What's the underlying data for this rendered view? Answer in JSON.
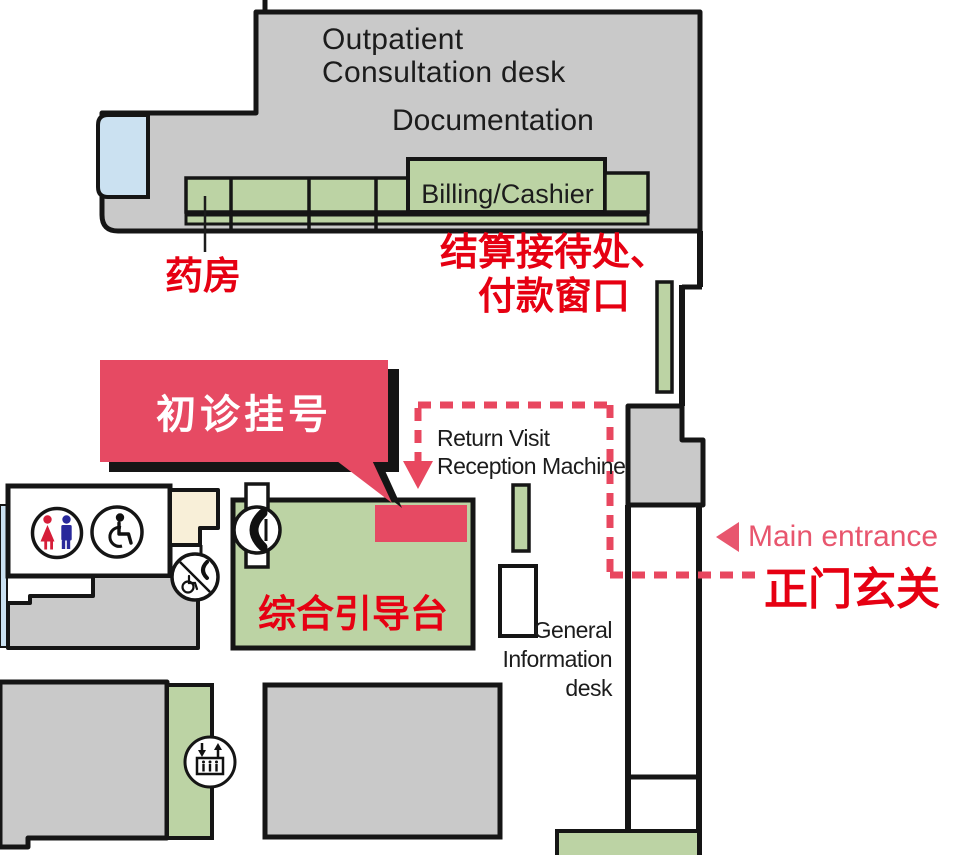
{
  "map": {
    "title_area": {
      "outpatient_line1": "Outpatient",
      "outpatient_line2": "Consultation desk",
      "documentation": "Documentation",
      "billing_cashier": "Billing/Cashier"
    },
    "labels": {
      "pharmacy_zh": "药房",
      "billing_reception_zh_line1": "结算接待处、",
      "billing_reception_zh_line2": "付款窗口",
      "first_visit_registration_zh": "初诊挂号",
      "return_visit_line1": "Return Visit",
      "return_visit_line2": "Reception Machine",
      "general_info_desk_zh": "综合引导台",
      "general_info_line1": "General",
      "general_info_line2": "Information",
      "general_info_line3": "desk",
      "main_entrance_en": "Main entrance",
      "main_entrance_zh": "正门玄关"
    },
    "icons": {
      "restroom": "male-female-restroom-icon",
      "wheelchair": "wheelchair-accessible-icon",
      "accessible_phone": "accessible-phone-icon",
      "public_phone": "public-phone-icon",
      "elevator": "elevator-icon",
      "entrance_arrow": "left-arrow-icon",
      "route_arrow": "down-arrow-icon"
    },
    "colors": {
      "wall": "#151515",
      "room_gray": "#c9c9c9",
      "counter_green": "#bcd3a4",
      "window_blue": "#cbe1f1",
      "room_cream": "#f8efd8",
      "highlight_red": "#e64a63",
      "text_red": "#e60012",
      "entrance_pink": "#e8566e",
      "female_red": "#d61e39",
      "male_blue": "#28289b"
    }
  }
}
